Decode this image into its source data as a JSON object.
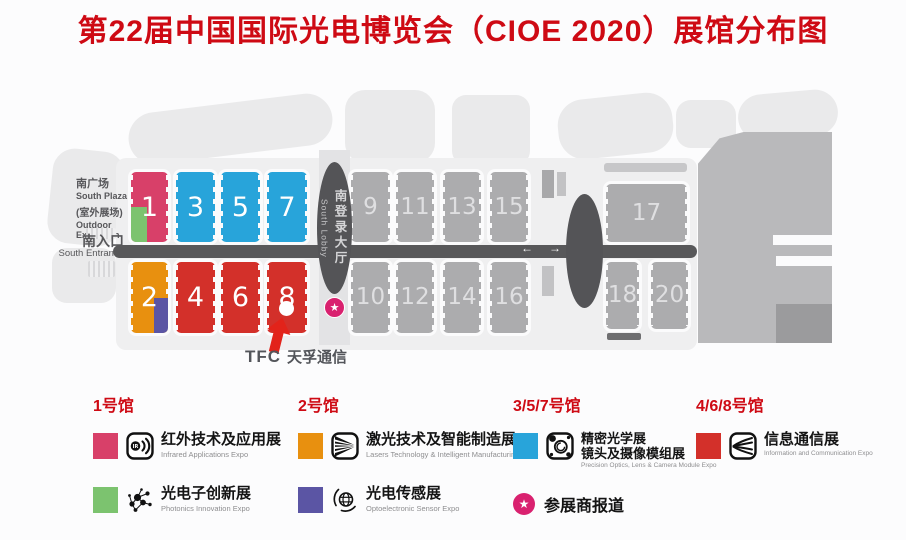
{
  "title": "第22届中国国际光电博览会（CIOE 2020）展馆分布图",
  "colors": {
    "title_red": "#CE0A14",
    "hall_pink": "#D84069",
    "hall_green": "#7CC36F",
    "hall_blue": "#28A4DA",
    "hall_orange": "#E8900F",
    "hall_red": "#D3302A",
    "hall_purple": "#5B55A4",
    "hall_gray": "#ACACAE",
    "corridor_dark": "#58585A",
    "star_magenta": "#D9216F"
  },
  "map": {
    "labels": {
      "south_plaza_cn": "南广场",
      "south_plaza_en": "South Plaza",
      "outdoor_cn": "(室外展场)",
      "outdoor_en1": "Outdoor",
      "outdoor_en2": "Exhibition",
      "south_entrance_cn": "南入口",
      "south_entrance_en": "South Entrance",
      "south_lobby_cn": "南登录大厅",
      "south_lobby_en": "South Lobby",
      "arrow_left": "←",
      "arrow_right": "→",
      "star": "★",
      "tfc_mark": "TFC",
      "tfc_name": "天孚通信"
    },
    "hall_labels": {
      "h1": "1",
      "h2": "2",
      "h3": "3",
      "h4": "4",
      "h5": "5",
      "h6": "6",
      "h7": "7",
      "h8": "8",
      "h9": "9",
      "h10": "10",
      "h11": "11",
      "h12": "12",
      "h13": "13",
      "h14": "14",
      "h15": "15",
      "h16": "16",
      "h17": "17",
      "h18": "18",
      "h20": "20"
    }
  },
  "legend": {
    "columns": [
      {
        "heading": "1号馆",
        "items": [
          {
            "swatch": "#D84069",
            "icon": "infrared-expo-icon",
            "title_cn": "红外技术及应用展",
            "title_en": "Infrared Applications Expo"
          },
          {
            "swatch": "#7CC36F",
            "icon": "photonics-expo-icon",
            "title_cn": "光电子创新展",
            "title_en": "Photonics Innovation Expo"
          }
        ]
      },
      {
        "heading": "2号馆",
        "items": [
          {
            "swatch": "#E8900F",
            "icon": "laser-expo-icon",
            "title_cn": "激光技术及智能制造展",
            "title_en": "Lasers Technology & Intelligent Manufacturing Expo"
          },
          {
            "swatch": "#5B55A4",
            "icon": "sensor-expo-icon",
            "title_cn": "光电传感展",
            "title_en": "Optoelectronic Sensor Expo"
          }
        ]
      },
      {
        "heading": "3/5/7号馆",
        "items": [
          {
            "swatch": "#28A4DA",
            "icon": "optics-expo-icon",
            "title_cn": "精密光学展",
            "title_cn2": "镜头及摄像模组展",
            "title_en": "Precision Optics, Lens & Camera Module Expo"
          }
        ]
      },
      {
        "heading": "4/6/8号馆",
        "items": [
          {
            "swatch": "#D3302A",
            "icon": "info-comm-expo-icon",
            "title_cn": "信息通信展",
            "title_en": "Information and Communication Expo"
          }
        ]
      }
    ],
    "star_note": {
      "star": "★",
      "label": "参展商报道"
    }
  }
}
